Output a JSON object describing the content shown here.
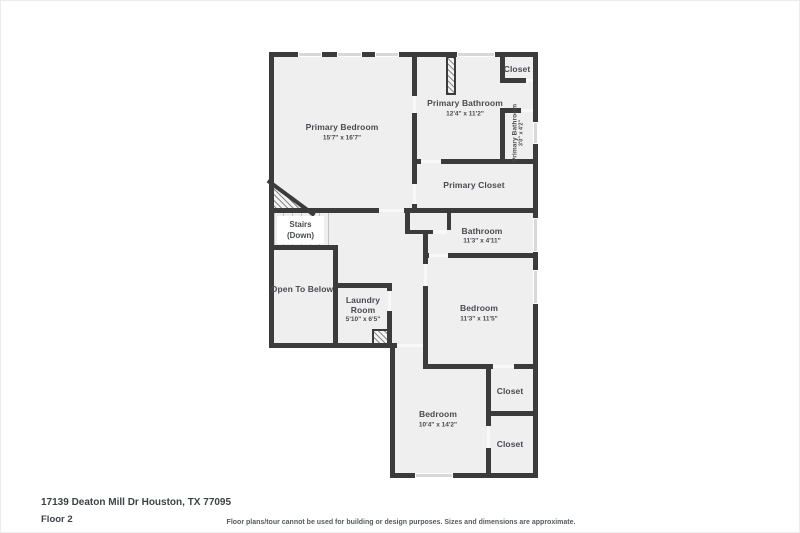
{
  "meta": {
    "address": "17139 Deaton Mill Dr Houston, TX 77095",
    "floor_label": "Floor 2",
    "disclaimer": "Floor plans/tour cannot be used for building or design purposes. Sizes and dimensions are approximate."
  },
  "colors": {
    "wall": "#3b3b3b",
    "room_fill": "#efefef",
    "window": "#d8d8d8",
    "label_text": "#494b4f"
  },
  "rooms": {
    "primary_bedroom": {
      "name": "Primary Bedroom",
      "dims": "15'7\" x 16'7\""
    },
    "primary_bathroom": {
      "name": "Primary Bathroom",
      "dims": "12'4\" x 11'2\""
    },
    "closet_top": {
      "name": "Closet"
    },
    "primary_bathroom_wc": {
      "name": "Primary Bathroom",
      "dims": "3'0\" x 4'2\""
    },
    "primary_closet": {
      "name": "Primary Closet"
    },
    "stairs": {
      "name": "Stairs",
      "sub": "(Down)"
    },
    "open_to_below": {
      "name": "Open To Below"
    },
    "laundry_room": {
      "name": "Laundry Room",
      "dims": "5'10\" x 6'5\""
    },
    "bathroom": {
      "name": "Bathroom",
      "dims": "11'3\" x 4'11\""
    },
    "bedroom_middle": {
      "name": "Bedroom",
      "dims": "11'3\" x 11'5\""
    },
    "bedroom_bottom": {
      "name": "Bedroom",
      "dims": "10'4\" x 14'2\""
    },
    "closet_middle": {
      "name": "Closet"
    },
    "closet_bottom": {
      "name": "Closet"
    }
  }
}
